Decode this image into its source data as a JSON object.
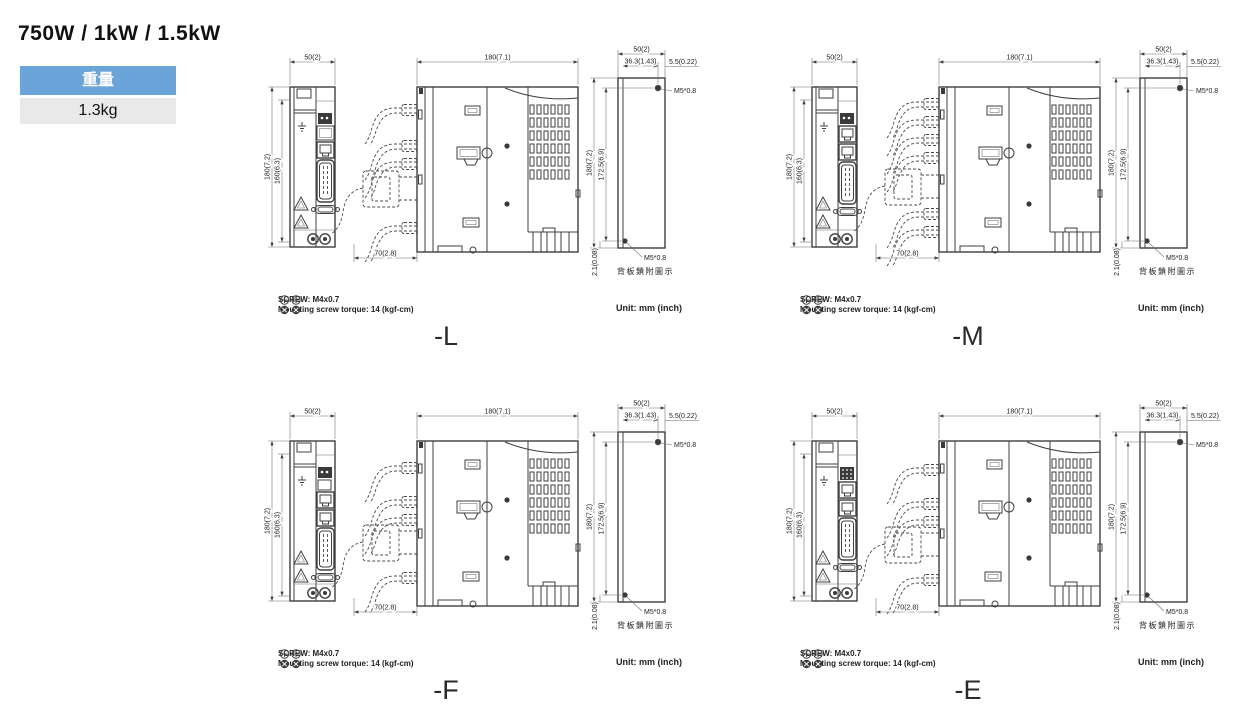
{
  "header": {
    "title": "750W / 1kW / 1.5kW"
  },
  "weight": {
    "label": "重量",
    "value": "1.3kg"
  },
  "colors": {
    "accent_blue": "#6aa4d8",
    "value_gray": "#e9e9e9",
    "line": "#3f3f3f"
  },
  "notes": {
    "screw": "SCREW: M4x0.7",
    "torque": "Mounting screw torque: 14 (kgf-cm)",
    "unit": "Unit: mm (inch)"
  },
  "dims": {
    "front_width": "50(2)",
    "front_height_outer": "180(7.2)",
    "front_height_inner": "160(6.3)",
    "side_width": "180(7.1)",
    "cable_space": "70(2.8)",
    "back_width": "50(2)",
    "back_height": "180(7.2)",
    "back_hole_span": "36.3(1.43)",
    "back_hole_edge": "5.5(0.22)",
    "back_hole_pitch": "172.5(6.9)",
    "back_bottom_gap": "2.1(0.08)",
    "screw_spec_top": "M5*0.8",
    "screw_spec_bottom": "M5*0.8",
    "back_caption": "背板鎖附圖示"
  },
  "variants": [
    {
      "id": "L",
      "label": "-L",
      "front_ports": [
        "plug",
        "panel",
        "rj45",
        "cn1",
        "dsub"
      ],
      "cable_ys": [
        68,
        104,
        122,
        186
      ],
      "connector_y": 148
    },
    {
      "id": "M",
      "label": "-M",
      "front_ports": [
        "plug",
        "rj45",
        "rj45",
        "cn1",
        "dsub"
      ],
      "cable_ys": [
        62,
        80,
        98,
        116,
        172,
        190
      ],
      "connector_y": 146
    },
    {
      "id": "F",
      "label": "-F",
      "front_ports": [
        "plug",
        "panel_small",
        "rj45",
        "rj45",
        "cn1",
        "dsub"
      ],
      "cable_ys": [
        72,
        106,
        124,
        182
      ],
      "connector_y": 148
    },
    {
      "id": "E",
      "label": "-E",
      "front_ports": [
        "pinblock",
        "rj45",
        "rj45",
        "cn1",
        "dsub"
      ],
      "cable_ys": [
        74,
        108,
        126,
        184
      ],
      "connector_y": 150
    }
  ]
}
